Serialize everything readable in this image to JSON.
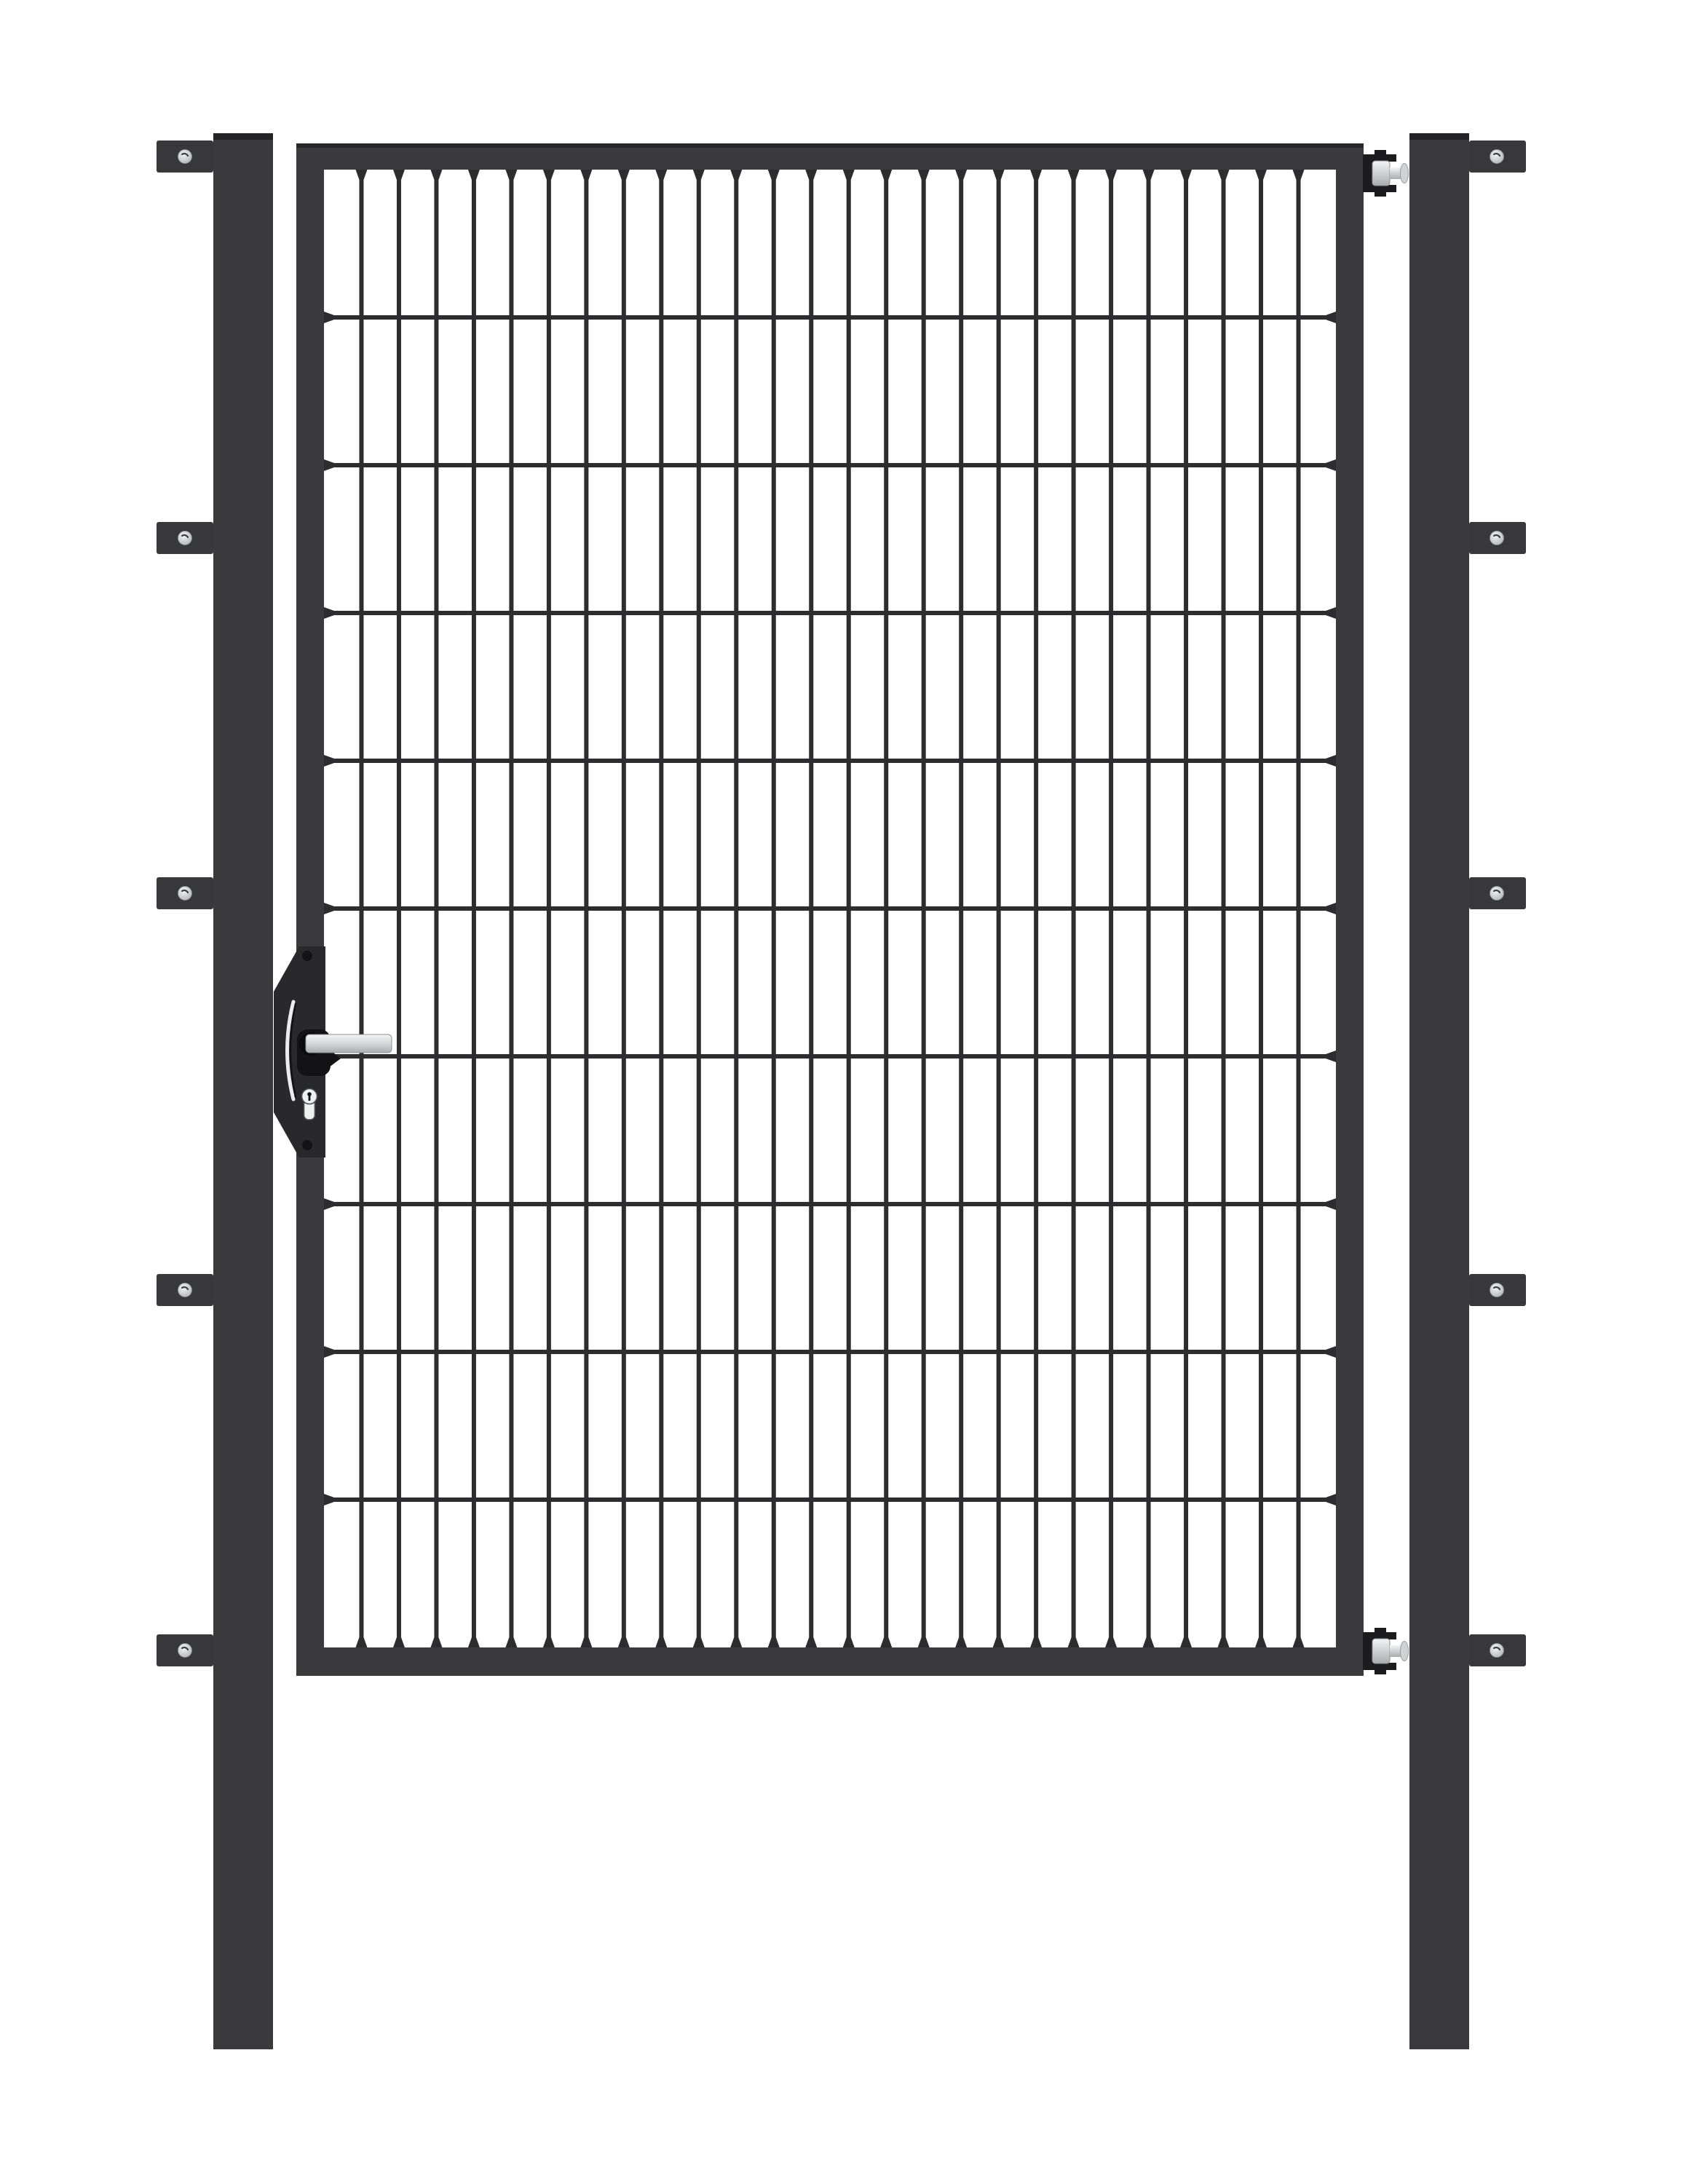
{
  "scene": {
    "type": "product-render",
    "subject": "single-wing metal garden gate with double-rod mesh infill, two square posts, anthracite finish on white background"
  },
  "colors": {
    "background": "#ffffff",
    "steel": "#3a3a3c",
    "steel_cap": "#242427",
    "wire": "#2d2d2f",
    "bracket": "#38383a",
    "clamp_black": "#1c1c1e",
    "lock_plate": "#29292b",
    "handle_black": "#131315",
    "silver_light": "#f3f5f5",
    "silver_mid": "#cfd3d4",
    "silver_deep": "#a9adae",
    "slot_light": "#ececec",
    "keyhole_fill": "#eef0f0"
  },
  "gate": {
    "mesh": {
      "columns": 27,
      "rows": 10,
      "vertical_wires": 26,
      "horizontal_wires": 9
    },
    "posts": {
      "count": 2,
      "brackets_per_post": 5
    },
    "hinges": {
      "count": 2,
      "side": "right"
    },
    "lock": {
      "handle": "silver-lever",
      "cylinder": "euro-profile",
      "plate_screws": 2
    }
  }
}
